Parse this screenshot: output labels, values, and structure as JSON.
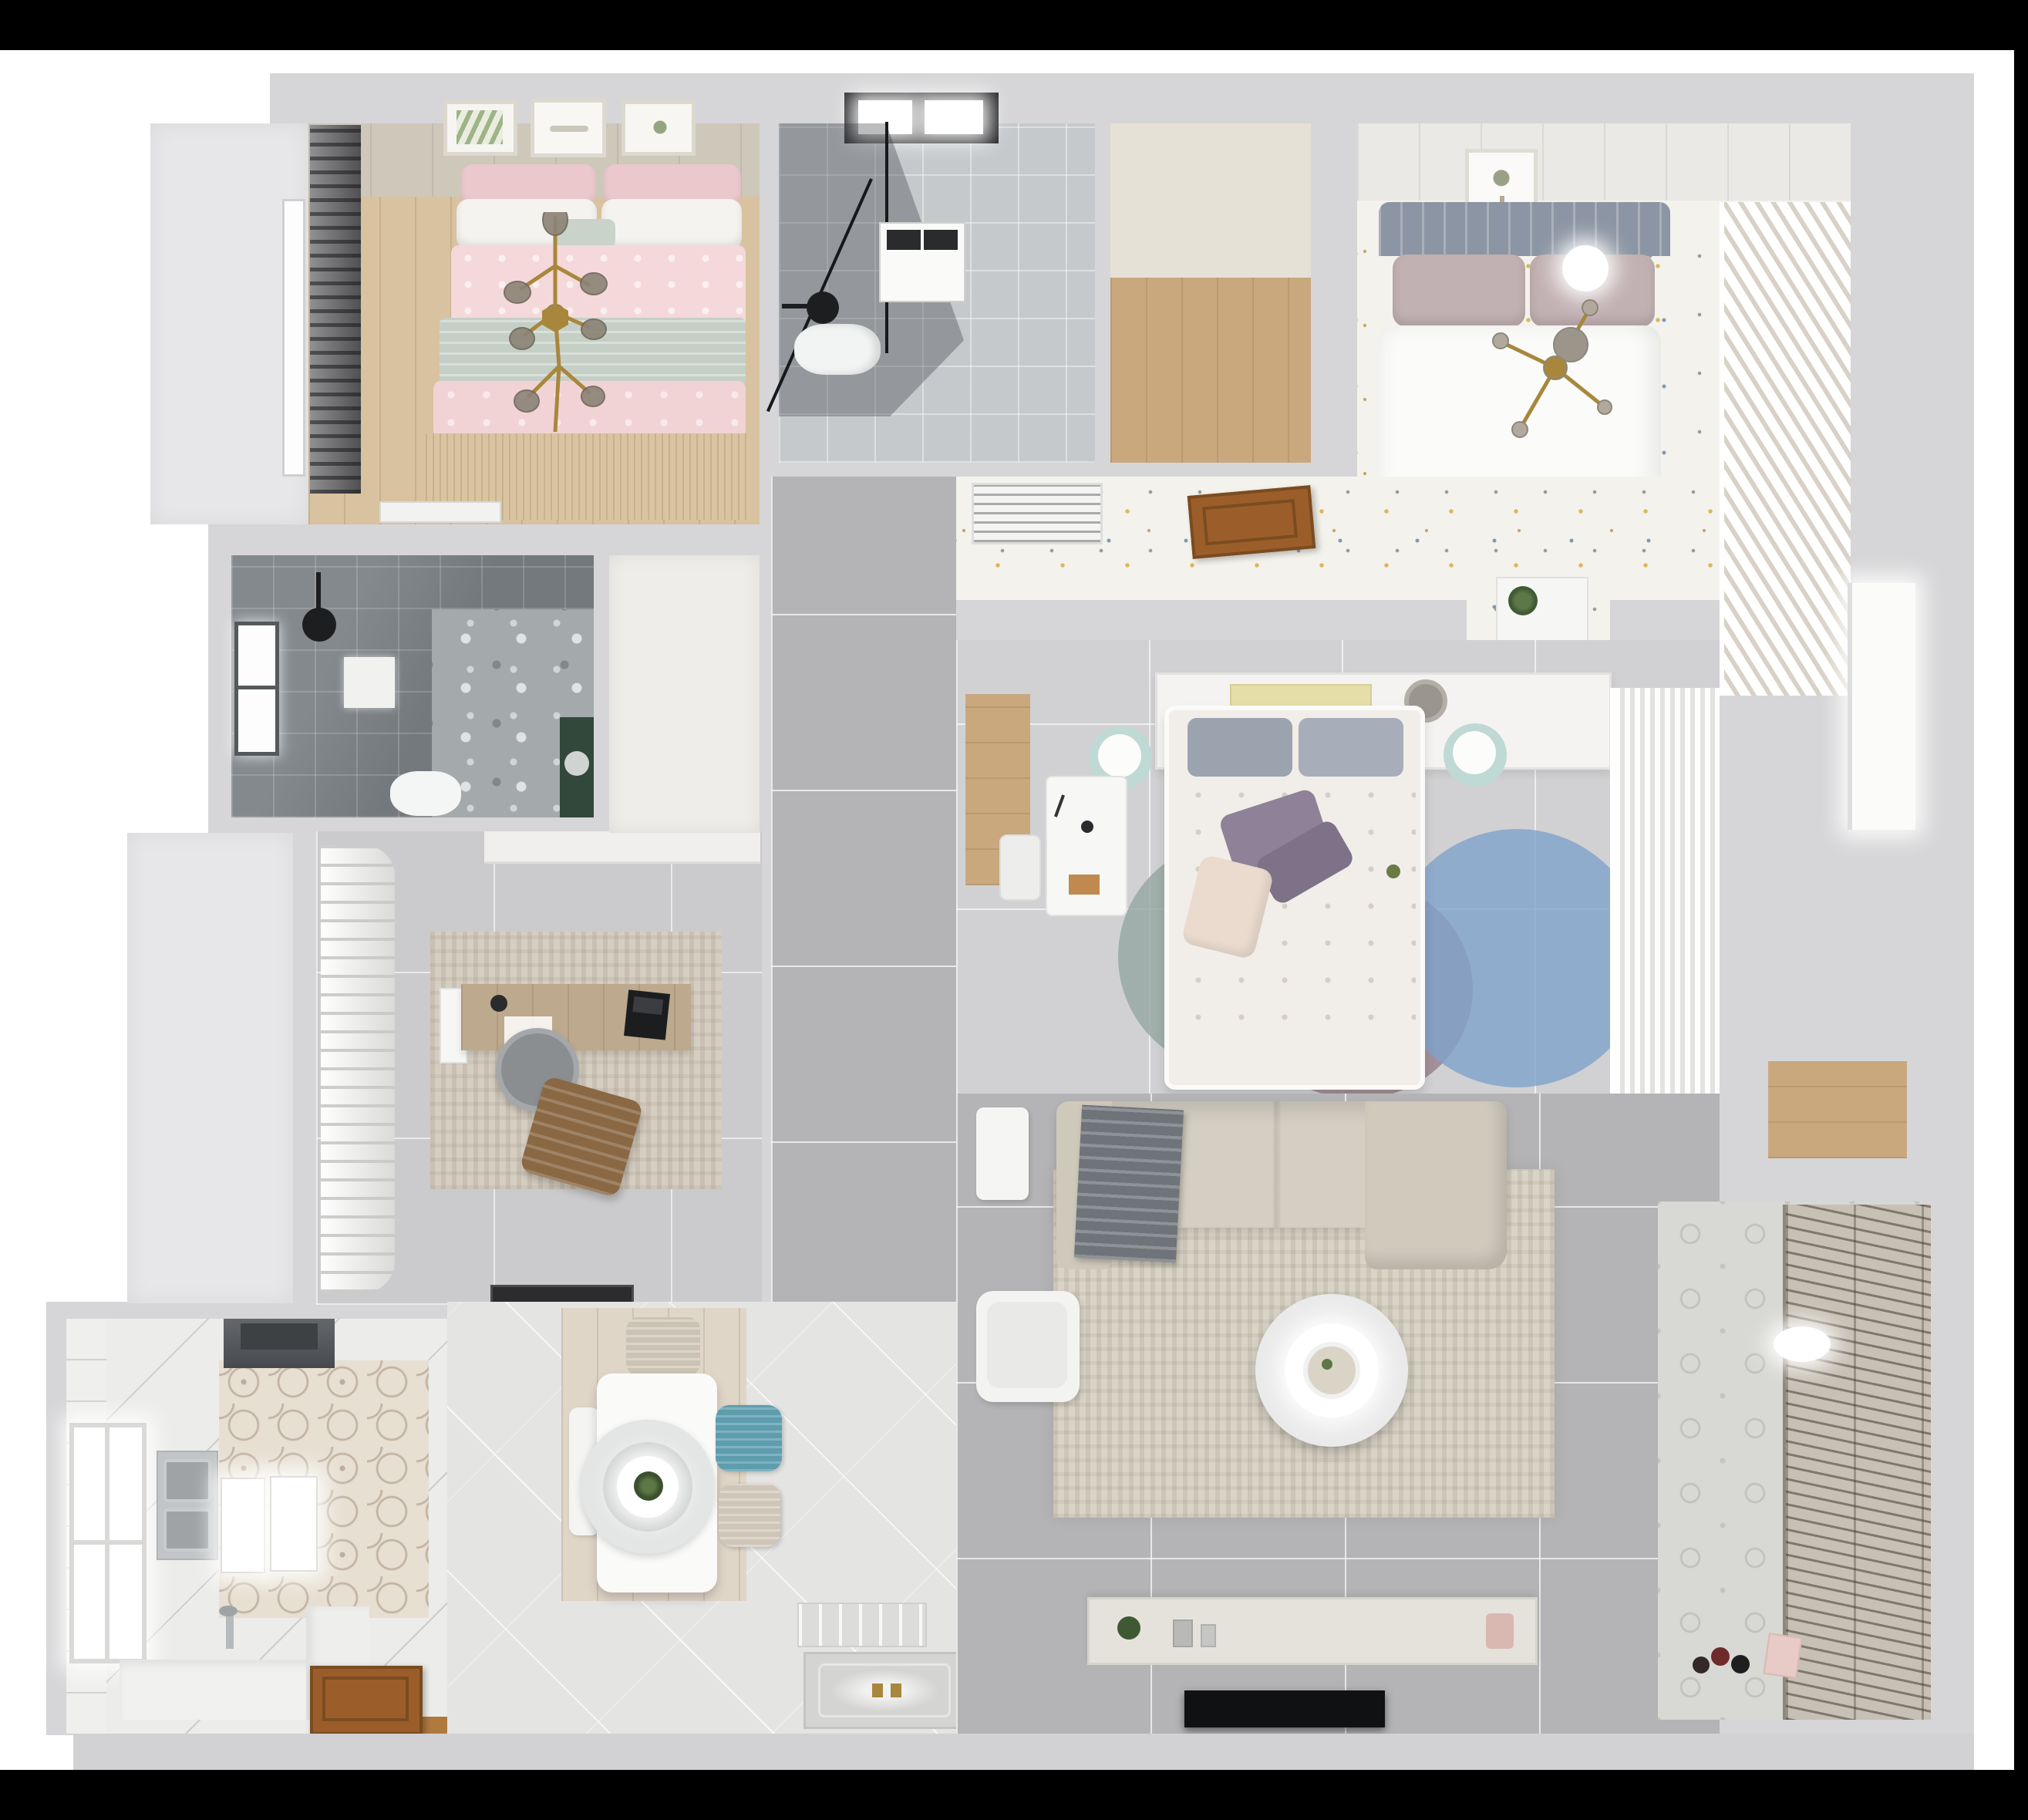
{
  "image": {
    "kind": "3d-rendered-floor-plan",
    "view": "top-down",
    "visible_text": "none"
  },
  "palette": {
    "page": "#000000",
    "canvas": "#ffffff",
    "wall": "#d6d6d8",
    "exterior_band": "#d2d2d4",
    "tile_gray": "#b4b4b6",
    "tile_light": "#e4e4e2",
    "tile_bath_light": "#c6c9cc",
    "tile_bath_dark": "#73797d",
    "carpet_speckle": "#f4f2ec",
    "wood_light": "#d8c2a0",
    "wood_mid": "#c9a87e",
    "wood_door": "#9b5e2a",
    "wood_entry": "#af7a3e",
    "bed_pink": "#f4d8da",
    "bed_sage": "#c5cfc6",
    "pillow_pink": "#eac8cc",
    "duvet_white": "#fbfbf9",
    "headboard_gray": "#8c95a3",
    "pillow_mauve": "#c2b1b3",
    "pillow_purple": "#8e8198",
    "rug_living": "#dad4c7",
    "rug_study": "#d6cec1",
    "rug_blue": "#7fa3cb",
    "rug_mauve": "#97808a",
    "rug_teal": "#93a6a1",
    "sofa": "#d5cfc3",
    "throw_gray": "#6f747a",
    "chair_teal": "#5e9dae",
    "chair_beige": "#cbc3b4",
    "chair_brown": "#8a6844",
    "desk_wood": "#bda98d",
    "mint": "#bfd9d5",
    "gold": "#a8873c",
    "hood": "#55585d",
    "tv_black": "#101113",
    "green_plant": "#4f6b3a",
    "console": "#e5e2dc",
    "blinds": "#c7c0b5"
  },
  "rooms": {
    "bedroom1": {
      "label": "Bedroom - pink double bed",
      "furniture": [
        "double-bed",
        "pink-duvet",
        "sage-blanket",
        "pillows",
        "gold-branch-chandelier",
        "wall-art-frames",
        "dark-curtains",
        "window",
        "dresser",
        "wood-floor",
        "tan-rug"
      ]
    },
    "bathroom1": {
      "label": "Bathroom with shower",
      "furniture": [
        "skylight-window",
        "glass-shower",
        "black-shower-head",
        "washing-machine",
        "toilet"
      ]
    },
    "walkin": {
      "label": "Walk-in closet hallway",
      "furniture": [
        "wood-floor"
      ]
    },
    "bedroom2": {
      "label": "Bedroom - white double bed",
      "furniture": [
        "double-bed",
        "gray-headboard",
        "mauve-pillows",
        "white-duvet",
        "gold-cross-chandelier",
        "art-frame",
        "louvered-wardrobe",
        "speckled-carpet",
        "ceiling-light"
      ]
    },
    "hall": {
      "label": "Inner hallway",
      "furniture": [
        "ac-vent",
        "open-wood-door",
        "console-plant"
      ]
    },
    "bedroom3": {
      "label": "Master bedroom",
      "furniture": [
        "double-bed",
        "gray-pillows",
        "purple-pillows",
        "floral-duvet",
        "headboard-console",
        "books",
        "round-hat",
        "mint-side-tables",
        "white-desk",
        "desk-chair",
        "circle-rug-blue",
        "circle-rug-mauve",
        "circle-rug-teal",
        "sheer-wardrobe",
        "wood-strip"
      ]
    },
    "corridor": {
      "label": "Corridor",
      "furniture": [
        "gray-floor-tiles",
        "dark-doormat"
      ]
    },
    "study": {
      "label": "Study / home office",
      "furniture": [
        "white-curtains",
        "textured-rug",
        "wood-desk",
        "office-chair",
        "laptop",
        "brown-lounge-chair",
        "cabinet-band"
      ]
    },
    "bathroom2": {
      "label": "Dark-tiled shower room",
      "furniture": [
        "window",
        "black-shower-head",
        "shower-tray",
        "toilet",
        "green-vanity",
        "terrazzo-floor"
      ]
    },
    "kitchen": {
      "label": "Kitchen",
      "furniture": [
        "range-hood",
        "double-sink",
        "faucet",
        "hex-tile-floor",
        "window",
        "white-counters",
        "glow-panels",
        "entry-wood-door"
      ]
    },
    "dining": {
      "label": "Dining area",
      "furniture": [
        "white-table",
        "ring-pendant-lamp",
        "plant-centerpiece",
        "teal-chair",
        "beige-chairs",
        "white-bench",
        "wood-platform",
        "patterned-doormat",
        "ornate-entry-mat"
      ]
    },
    "living": {
      "label": "Living room",
      "furniture": [
        "l-shaped-sofa",
        "gray-throw",
        "beige-rug",
        "round-two-tier-coffee-table",
        "white-armchair",
        "side-table",
        "tv-console",
        "decor-items",
        "tv-panel"
      ]
    },
    "balcony": {
      "label": "Balcony / laundry",
      "furniture": [
        "slatted-blinds",
        "ceiling-lamp-glow",
        "patterned-floor",
        "shoes",
        "pink-box",
        "wood-shelf-niche"
      ]
    }
  }
}
